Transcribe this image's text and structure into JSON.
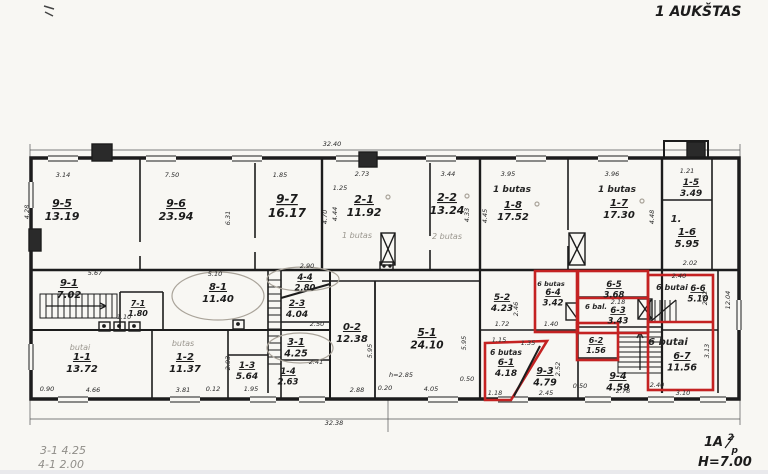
{
  "title": "1 AUKŠTAS",
  "corner_mark": {
    "main": "1A",
    "sup": "2",
    "sub": "p",
    "height_note": "H=7.00"
  },
  "notes": {
    "note1": "3-1  4.25",
    "note2": "4-1  2.00"
  },
  "colors": {
    "ink": "#1c1c1c",
    "pencil": "#9a968e",
    "highlight_red": "#c42222",
    "paper": "#f8f7f3"
  },
  "rooms": {
    "r9_5": {
      "code": "9-5",
      "area": "13.19"
    },
    "r9_6": {
      "code": "9-6",
      "area": "23.94"
    },
    "r9_7": {
      "code": "9-7",
      "area": "16.17"
    },
    "r2_1": {
      "code": "2-1",
      "area": "11.92"
    },
    "r2_2": {
      "code": "2-2",
      "area": "13.24"
    },
    "r1_8": {
      "code": "1-8",
      "area": "17.52"
    },
    "r1_7": {
      "code": "1-7",
      "area": "17.30"
    },
    "r1_5": {
      "code": "1-5",
      "area": "3.49"
    },
    "r1_6": {
      "code": "1-6",
      "area": "5.95"
    },
    "r9_1": {
      "code": "9-1",
      "area": "7.02"
    },
    "r7_1": {
      "code": "7-1",
      "area": "1.80"
    },
    "r8_1": {
      "code": "8-1",
      "area": "11.40"
    },
    "r4_4": {
      "code": "4-4",
      "area": "2.80"
    },
    "r2_3": {
      "code": "2-3",
      "area": "4.04"
    },
    "r3_1": {
      "code": "3-1",
      "area": "4.25"
    },
    "r1_4": {
      "code": "1-4",
      "area": "2.63"
    },
    "r1_1": {
      "code": "1-1",
      "area": "13.72"
    },
    "r1_2": {
      "code": "1-2",
      "area": "11.37"
    },
    "r1_3": {
      "code": "1-3",
      "area": "5.64"
    },
    "r0_2": {
      "code": "0-2",
      "area": "12.38"
    },
    "r5_1": {
      "code": "5-1",
      "area": "24.10"
    },
    "r5_2": {
      "code": "5-2",
      "area": "4.23"
    },
    "r6_4": {
      "code": "6-4",
      "area": "3.42"
    },
    "r6_5": {
      "code": "6-5",
      "area": "3.68"
    },
    "r6_3": {
      "code": "6-3",
      "area": "3.43"
    },
    "r6_2": {
      "code": "6-2",
      "area": "1.56"
    },
    "r6_1": {
      "code": "6-1",
      "area": "4.18"
    },
    "r9_3": {
      "code": "9-3",
      "area": "4.79"
    },
    "r9_4": {
      "code": "9-4",
      "area": "4.59"
    },
    "r6_6": {
      "code": "6-6",
      "area": "5.10"
    },
    "r6_7": {
      "code": "6-7",
      "area": "11.56"
    }
  },
  "annotations": {
    "butas_1_8": "1 butas",
    "butas_1_7": "1 butas",
    "butas_2_1": "1 butas",
    "butas_2_2": "2 butas",
    "butai_1_1": "butai",
    "butas_1_2": "butas",
    "butas_6_4": "6 butas",
    "bal_6_3": "6 bal.",
    "butas_6_1": "6 butas",
    "butai_6_6": "6 butai",
    "butai_6_7": "6 butai",
    "one_mark": "1."
  },
  "dimensions": {
    "top_total": "32.40",
    "bottom_total": "32.38",
    "d3_14": "3.14",
    "d7_50": "7.50",
    "d1_85": "1.85",
    "d2_73": "2.73",
    "d3_44": "3.44",
    "d3_95": "3.95",
    "d3_96": "3.96",
    "d1_21": "1.21",
    "d4_28": "4.28",
    "d6_31": "6.31",
    "d1_25": "1.25",
    "d4_70": "4.70",
    "d4_44": "4.44",
    "d4_33": "4.33",
    "d4_45": "4.45",
    "d4_48": "4.48",
    "d2_02": "2.02",
    "d2_40a": "2.40",
    "d2_82": "2.82",
    "d12_04": "12.04",
    "d3_13": "3.13",
    "d2_40b": "2.40",
    "d3_10": "3.10",
    "d5_67": "5.67",
    "d5_10": "5.10",
    "d1_10": "1.10",
    "d0_90": "0.90",
    "d4_66": "4.66",
    "d3_81": "3.81",
    "d0_12": "0.12",
    "d1_95": "1.95",
    "d2_90": "2.90",
    "d2_50": "2.50",
    "d2_41": "2.41",
    "d2_93": "2.93",
    "d2_88": "2.88",
    "d0_20": "0.20",
    "dh2_85": "h=2.85",
    "d4_05": "4.05",
    "d0_50a": "0.50",
    "d5_95a": "5.95",
    "d5_95b": "5.95",
    "d1_72": "1.72",
    "d2_46": "2.46",
    "d1_40": "1.40",
    "d1_35": "1.35",
    "d2_52": "2.52",
    "d1_15": "1.15",
    "d1_18": "1.18",
    "d2_45": "2.45",
    "d2_78": "2.78",
    "d0_50b": "0.50",
    "d2_18": "2.18"
  }
}
